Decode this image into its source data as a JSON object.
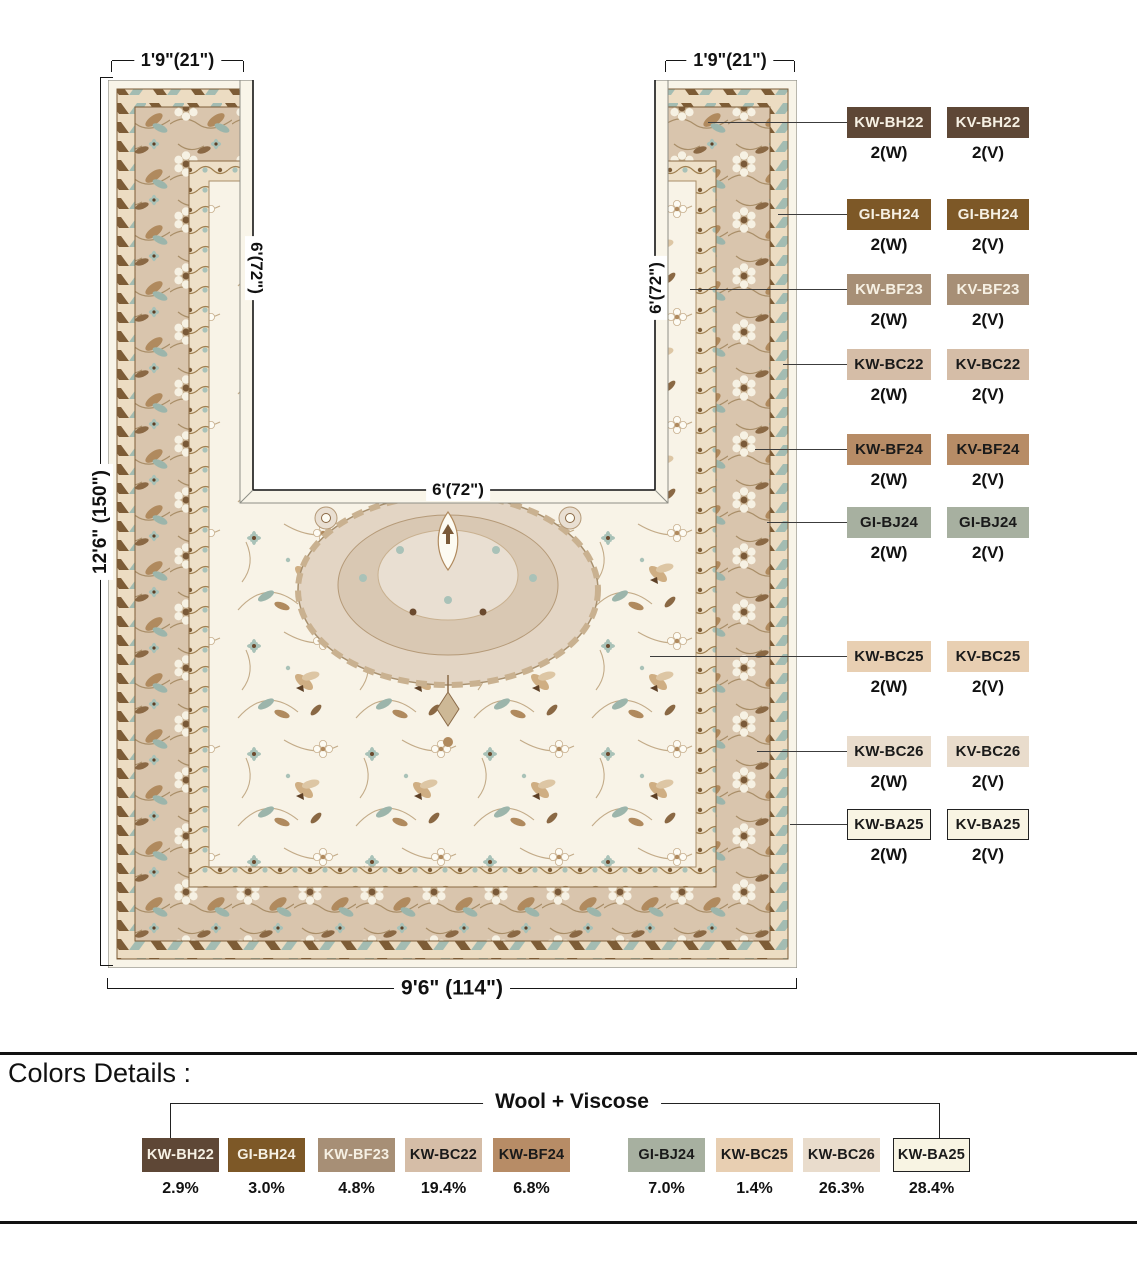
{
  "diagram": {
    "dimensions": {
      "top_left": "1'9\"(21\")",
      "top_right": "1'9\"(21\")",
      "outer_left": "12'6\" (150\")",
      "inner_left": "6'(72\")",
      "inner_right": "6'(72\")",
      "inner_bottom": "6'(72\")",
      "bottom": "9'6\" (114\")"
    },
    "swatch_rows": [
      {
        "wool_code": "KW-BH22",
        "viscose_code": "KV-BH22",
        "wool_qty": "2(W)",
        "viscose_qty": "2(V)",
        "color": "#5e4736",
        "text_color": "#f6f0e3",
        "outlined": false
      },
      {
        "wool_code": "GI-BH24",
        "viscose_code": "GI-BH24",
        "wool_qty": "2(W)",
        "viscose_qty": "2(V)",
        "color": "#7d5827",
        "text_color": "#f6f0e3",
        "outlined": false
      },
      {
        "wool_code": "KW-BF23",
        "viscose_code": "KV-BF23",
        "wool_qty": "2(W)",
        "viscose_qty": "2(V)",
        "color": "#a78f76",
        "text_color": "#f6f0e3",
        "outlined": false
      },
      {
        "wool_code": "KW-BC22",
        "viscose_code": "KV-BC22",
        "wool_qty": "2(W)",
        "viscose_qty": "2(V)",
        "color": "#d5bda7",
        "text_color": "#1a1a1a",
        "outlined": false
      },
      {
        "wool_code": "KW-BF24",
        "viscose_code": "KV-BF24",
        "wool_qty": "2(W)",
        "viscose_qty": "2(V)",
        "color": "#b78c66",
        "text_color": "#1a1a1a",
        "outlined": false
      },
      {
        "wool_code": "GI-BJ24",
        "viscose_code": "GI-BJ24",
        "wool_qty": "2(W)",
        "viscose_qty": "2(V)",
        "color": "#a7b0a0",
        "text_color": "#1a1a1a",
        "outlined": false
      },
      {
        "wool_code": "KW-BC25",
        "viscose_code": "KV-BC25",
        "wool_qty": "2(W)",
        "viscose_qty": "2(V)",
        "color": "#e8cfb2",
        "text_color": "#1a1a1a",
        "outlined": false
      },
      {
        "wool_code": "KW-BC26",
        "viscose_code": "KV-BC26",
        "wool_qty": "2(W)",
        "viscose_qty": "2(V)",
        "color": "#e9dccc",
        "text_color": "#1a1a1a",
        "outlined": false
      },
      {
        "wool_code": "KW-BA25",
        "viscose_code": "KV-BA25",
        "wool_qty": "2(W)",
        "viscose_qty": "2(V)",
        "color": "#f8f4e3",
        "text_color": "#1a1a1a",
        "outlined": true
      }
    ],
    "rug_colors": {
      "cream_edge": "#f8f4e8",
      "field": "#f8f3e7",
      "main_border": "#d9c5ad",
      "guard_band": "#eee0c8",
      "zigzag_band": "#ecdcc2",
      "accent_blue": "#a9c2b8",
      "brown": "#7d5c36",
      "dark_brown": "#5d4026",
      "medallion": "#e3d5c4"
    }
  },
  "colors_details": {
    "title": "Colors Details :",
    "group_label": "Wool + Viscose",
    "swatches": [
      {
        "code": "KW-BH22",
        "percent": "2.9%",
        "color": "#5e4736",
        "text_color": "#f6f0e3",
        "outlined": false
      },
      {
        "code": "GI-BH24",
        "percent": "3.0%",
        "color": "#7d5827",
        "text_color": "#f6f0e3",
        "outlined": false
      },
      {
        "code": "KW-BF23",
        "percent": "4.8%",
        "color": "#a78f76",
        "text_color": "#f6f0e3",
        "outlined": false
      },
      {
        "code": "KW-BC22",
        "percent": "19.4%",
        "color": "#d5bda7",
        "text_color": "#1a1a1a",
        "outlined": false
      },
      {
        "code": "KW-BF24",
        "percent": "6.8%",
        "color": "#b78c66",
        "text_color": "#1a1a1a",
        "outlined": false
      },
      {
        "code": "GI-BJ24",
        "percent": "7.0%",
        "color": "#a7b0a0",
        "text_color": "#1a1a1a",
        "outlined": false
      },
      {
        "code": "KW-BC25",
        "percent": "1.4%",
        "color": "#e8cfb2",
        "text_color": "#1a1a1a",
        "outlined": false
      },
      {
        "code": "KW-BC26",
        "percent": "26.3%",
        "color": "#e9dccc",
        "text_color": "#1a1a1a",
        "outlined": false
      },
      {
        "code": "KW-BA25",
        "percent": "28.4%",
        "color": "#f8f4e3",
        "text_color": "#1a1a1a",
        "outlined": true
      }
    ]
  }
}
